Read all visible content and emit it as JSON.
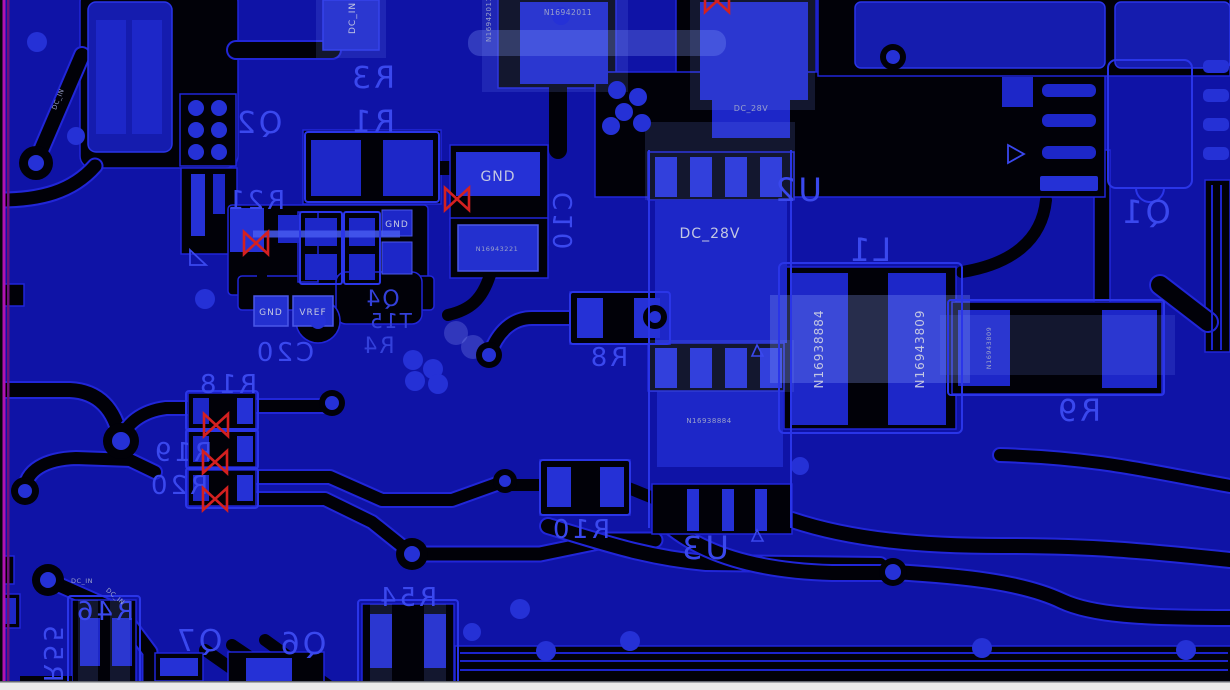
{
  "app": "pcb-layout-viewer",
  "colors": {
    "board_background": "#0f13a6",
    "copper_dark": "#010108",
    "pad_bright": "#2531d6",
    "pad_medium": "#1d27c8",
    "silkscreen_blue": "#3a48ee",
    "net_label_light": "#c3c7e2",
    "drc_marker_red": "#d42020",
    "board_edge_magenta": "#b013b0",
    "board_edge_purple": "#70107a",
    "bottom_strip": "#ebebeb"
  },
  "icons": {
    "drc_marker": "red-bowtie-x",
    "polarity_mark": "triangle-outline",
    "via": "filled-circle"
  },
  "labels": [
    {
      "id": "dc-in-top",
      "text": "DC_IN"
    },
    {
      "id": "net-n16942011-vertical",
      "text": "N16942011"
    },
    {
      "id": "net-n16942011-horizontal",
      "text": "N16942011"
    },
    {
      "id": "designator-r3",
      "text": "R3"
    },
    {
      "id": "designator-r1",
      "text": "R1"
    },
    {
      "id": "designator-q2",
      "text": "Q2"
    },
    {
      "id": "designator-r21",
      "text": "R21"
    },
    {
      "id": "net-gnd-big",
      "text": "GND"
    },
    {
      "id": "net-gnd-small",
      "text": "GND"
    },
    {
      "id": "net-n16943221",
      "text": "N16943221"
    },
    {
      "id": "designator-c10",
      "text": "C10"
    },
    {
      "id": "net-dc28v-small",
      "text": "DC_28V"
    },
    {
      "id": "designator-u2",
      "text": "U2"
    },
    {
      "id": "net-dc28v-big",
      "text": "DC_28V"
    },
    {
      "id": "designator-l1",
      "text": "L1"
    },
    {
      "id": "net-n16938884-l1",
      "text": "N16938884"
    },
    {
      "id": "net-n16943809-l1",
      "text": "N16943809"
    },
    {
      "id": "net-n16943809-small",
      "text": "N16943809"
    },
    {
      "id": "designator-q1",
      "text": "Q1"
    },
    {
      "id": "designator-r9",
      "text": "R9"
    },
    {
      "id": "net-gnd-pad",
      "text": "GND"
    },
    {
      "id": "net-vref-pad",
      "text": "VREF"
    },
    {
      "id": "designator-c20",
      "text": "C20"
    },
    {
      "id": "designator-cluster-a",
      "text": "Q4"
    },
    {
      "id": "designator-cluster-b",
      "text": "T15"
    },
    {
      "id": "designator-cluster-c",
      "text": "R4"
    },
    {
      "id": "designator-r8",
      "text": "R8"
    },
    {
      "id": "net-n16938884-u3",
      "text": "N16938884"
    },
    {
      "id": "designator-r18",
      "text": "R18"
    },
    {
      "id": "designator-r19",
      "text": "R19"
    },
    {
      "id": "designator-r20",
      "text": "R20"
    },
    {
      "id": "designator-r10",
      "text": "R10"
    },
    {
      "id": "designator-u3",
      "text": "U3"
    },
    {
      "id": "designator-r54",
      "text": "R54"
    },
    {
      "id": "designator-r46",
      "text": "R46"
    },
    {
      "id": "designator-r55",
      "text": "R55"
    },
    {
      "id": "designator-q7",
      "text": "Q7"
    },
    {
      "id": "designator-q6",
      "text": "Q6"
    },
    {
      "id": "net-dc-in-trace",
      "text": "DC_IN"
    },
    {
      "id": "net-dc-in-diag-bottom",
      "text": "DC_IN"
    },
    {
      "id": "net-dc-in-diag-top",
      "text": "DC_IN"
    }
  ]
}
